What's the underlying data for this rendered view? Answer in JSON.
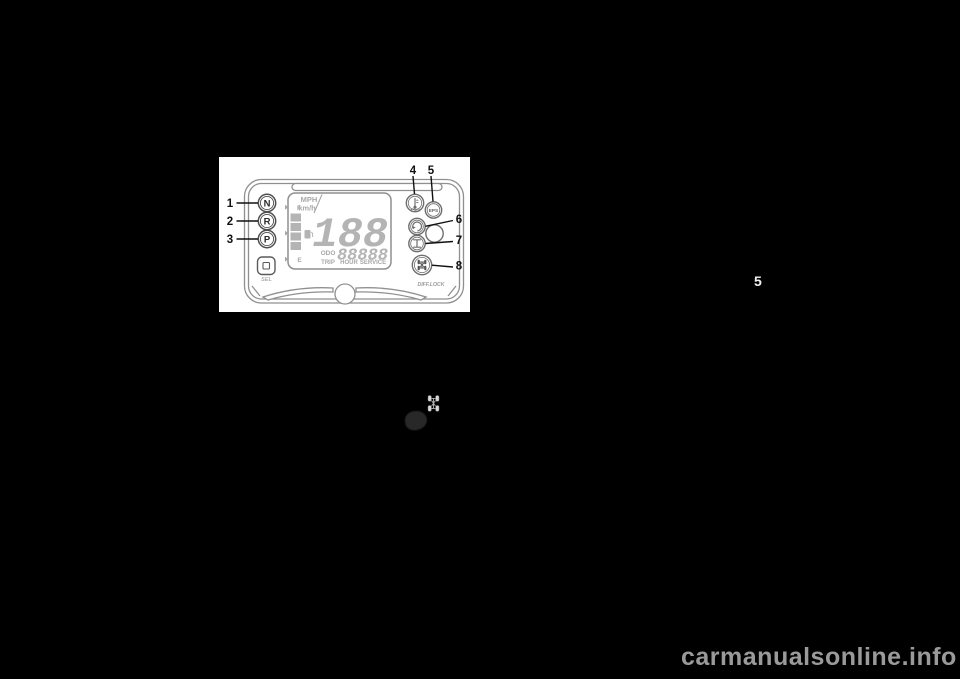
{
  "page": {
    "background_color": "#000000",
    "section_number": "5",
    "watermark": "carmanualsonline.info",
    "watermark_color": "#9a9a9a"
  },
  "figure": {
    "description": "multi-function-meter-diagram",
    "callouts": {
      "c1": "1",
      "c2": "2",
      "c3": "3",
      "c4": "4",
      "c5": "5",
      "c6": "6",
      "c7": "7",
      "c8": "8"
    },
    "gear_indicators": {
      "neutral": "N",
      "reverse": "R",
      "park": "P"
    },
    "eps_label": "EPS",
    "select_button_label": "SEL",
    "diff_lock_label": "DIFF.LOCK",
    "display": {
      "unit_mph": "MPH",
      "unit_kmh": "km/h",
      "speed_digits": "188",
      "fuel_full": "F",
      "fuel_empty": "E",
      "odo_label": "ODO",
      "trip_label": "TRIP",
      "hour_label": "HOUR",
      "service_label": "SERVICE",
      "odo_digits": "88888"
    },
    "icon_names": [
      "coolant-temperature-icon",
      "eps-indicator",
      "drive-mode-icon",
      "gear-icon",
      "diff-lock-icon"
    ],
    "colors": {
      "outline_gray": "#909090",
      "lcd_gray": "#b4b4b4",
      "callout_black": "#111111"
    }
  },
  "inline_icons": {
    "icon_a": "diff-lock-mini-icon",
    "icon_b": "indicator-blob-icon"
  }
}
